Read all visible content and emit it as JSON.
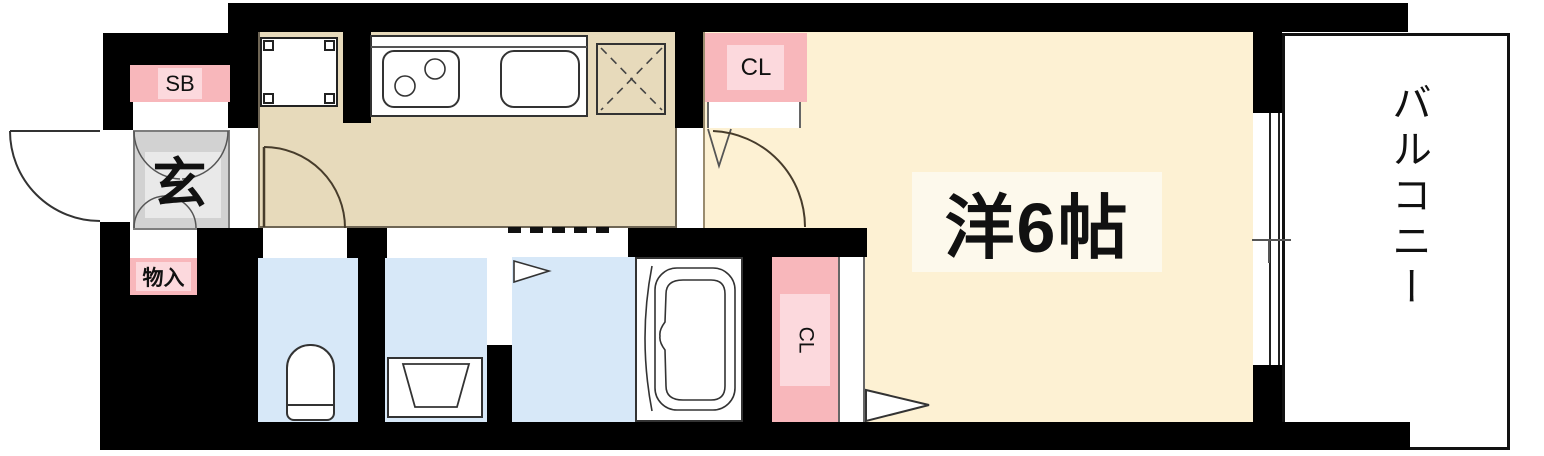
{
  "floorplan": {
    "type": "japanese-apartment-1K-floorplan",
    "labels": {
      "shoe_box": "SB",
      "entrance": "玄",
      "storage": "物入",
      "closet_upper": "CL",
      "closet_lower": "CL",
      "western_room": "洋6帖",
      "balcony": "バルコニー"
    },
    "colors": {
      "wall": "#000000",
      "kitchen_floor": "#e7dabb",
      "room_floor": "#fdf1d3",
      "room_label_bg": "#fdf9ec",
      "wet_area_floor": "#d7e8f8",
      "closet_pink": "#f8b7bb",
      "closet_pink_light": "#fcd9dd",
      "genkan_gray": "#d2d2d2",
      "genkan_gray_light": "#e9e9e9",
      "balcony_bg": "#ffffff",
      "line": "#333333"
    }
  }
}
